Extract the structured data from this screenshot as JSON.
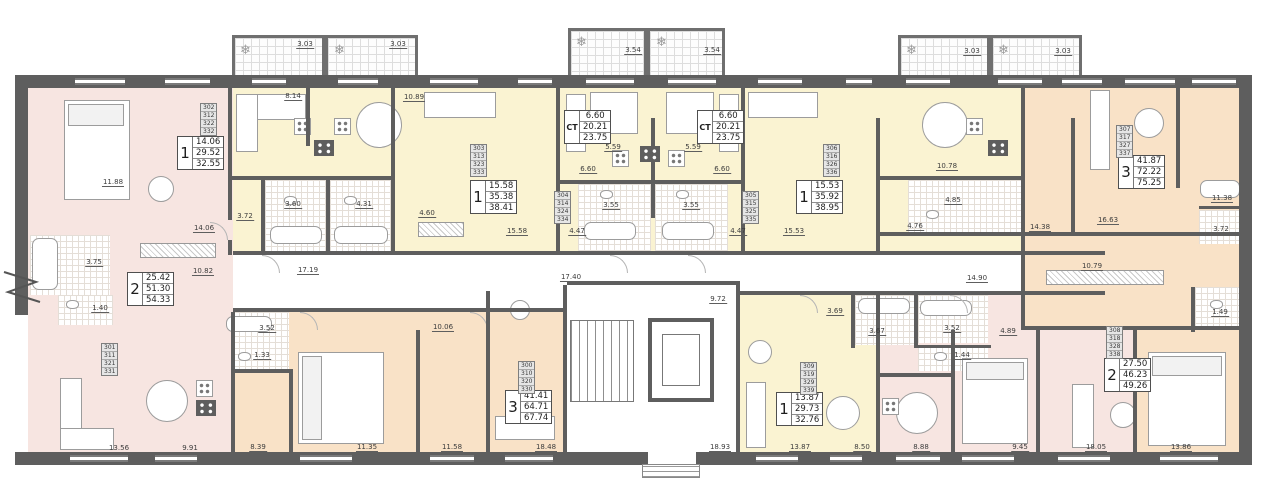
{
  "colors": {
    "wall": "#5e5e5e",
    "pink": "#f7e5e1",
    "yellow": "#faf3d2",
    "peach": "#f9e2c7"
  },
  "icons": {
    "snowflake": "❄"
  },
  "units": [
    {
      "type_label": "2",
      "areas": [
        "25.42",
        "51.30",
        "54.33"
      ],
      "numbers": [
        "301",
        "311",
        "321",
        "331"
      ]
    },
    {
      "type_label": "1",
      "areas": [
        "14.06",
        "29.52",
        "32.55"
      ],
      "numbers": [
        "302",
        "312",
        "322",
        "332"
      ]
    },
    {
      "type_label": "1",
      "areas": [
        "15.58",
        "35.38",
        "38.41"
      ],
      "numbers": [
        "303",
        "313",
        "323",
        "333"
      ]
    },
    {
      "type_label": "СТ",
      "areas": [
        "6.60",
        "20.21",
        "23.75"
      ],
      "numbers": [
        "304",
        "314",
        "324",
        "334"
      ]
    },
    {
      "type_label": "СТ",
      "areas": [
        "6.60",
        "20.21",
        "23.75"
      ],
      "numbers": [
        "305",
        "315",
        "325",
        "335"
      ]
    },
    {
      "type_label": "1",
      "areas": [
        "15.53",
        "35.92",
        "38.95"
      ],
      "numbers": [
        "306",
        "316",
        "326",
        "336"
      ]
    },
    {
      "type_label": "3",
      "areas": [
        "41.87",
        "72.22",
        "75.25"
      ],
      "numbers": [
        "307",
        "317",
        "327",
        "337"
      ]
    },
    {
      "type_label": "3",
      "areas": [
        "41.41",
        "64.71",
        "67.74"
      ],
      "numbers": [
        "300",
        "310",
        "320",
        "330"
      ]
    },
    {
      "type_label": "1",
      "areas": [
        "13.87",
        "29.73",
        "32.76"
      ],
      "numbers": [
        "309",
        "319",
        "329",
        "339"
      ]
    },
    {
      "type_label": "2",
      "areas": [
        "27.50",
        "46.23",
        "49.26"
      ],
      "numbers": [
        "308",
        "318",
        "328",
        "338"
      ]
    }
  ],
  "dims": [
    "3.03",
    "3.03",
    "3.54",
    "3.54",
    "3.03",
    "3.03",
    "8.14",
    "10.89",
    "11.88",
    "14.06",
    "3.72",
    "3.60",
    "4.31",
    "4.60",
    "15.58",
    "5.59",
    "5.59",
    "6.60",
    "6.60",
    "3.55",
    "3.55",
    "4.47",
    "4.47",
    "15.53",
    "10.78",
    "4.85",
    "4.76",
    "14.38",
    "16.63",
    "11.38",
    "3.72",
    "3.75",
    "1.40",
    "10.82",
    "17.19",
    "17.40",
    "9.72",
    "14.90",
    "10.79",
    "1.49",
    "3.52",
    "1.33",
    "10.06",
    "3.69",
    "3.67",
    "3.52",
    "1.44",
    "4.89",
    "13.56",
    "9.91",
    "8.39",
    "11.35",
    "11.58",
    "18.48",
    "18.93",
    "13.87",
    "8.50",
    "8.88",
    "9.45",
    "18.05",
    "13.86"
  ]
}
